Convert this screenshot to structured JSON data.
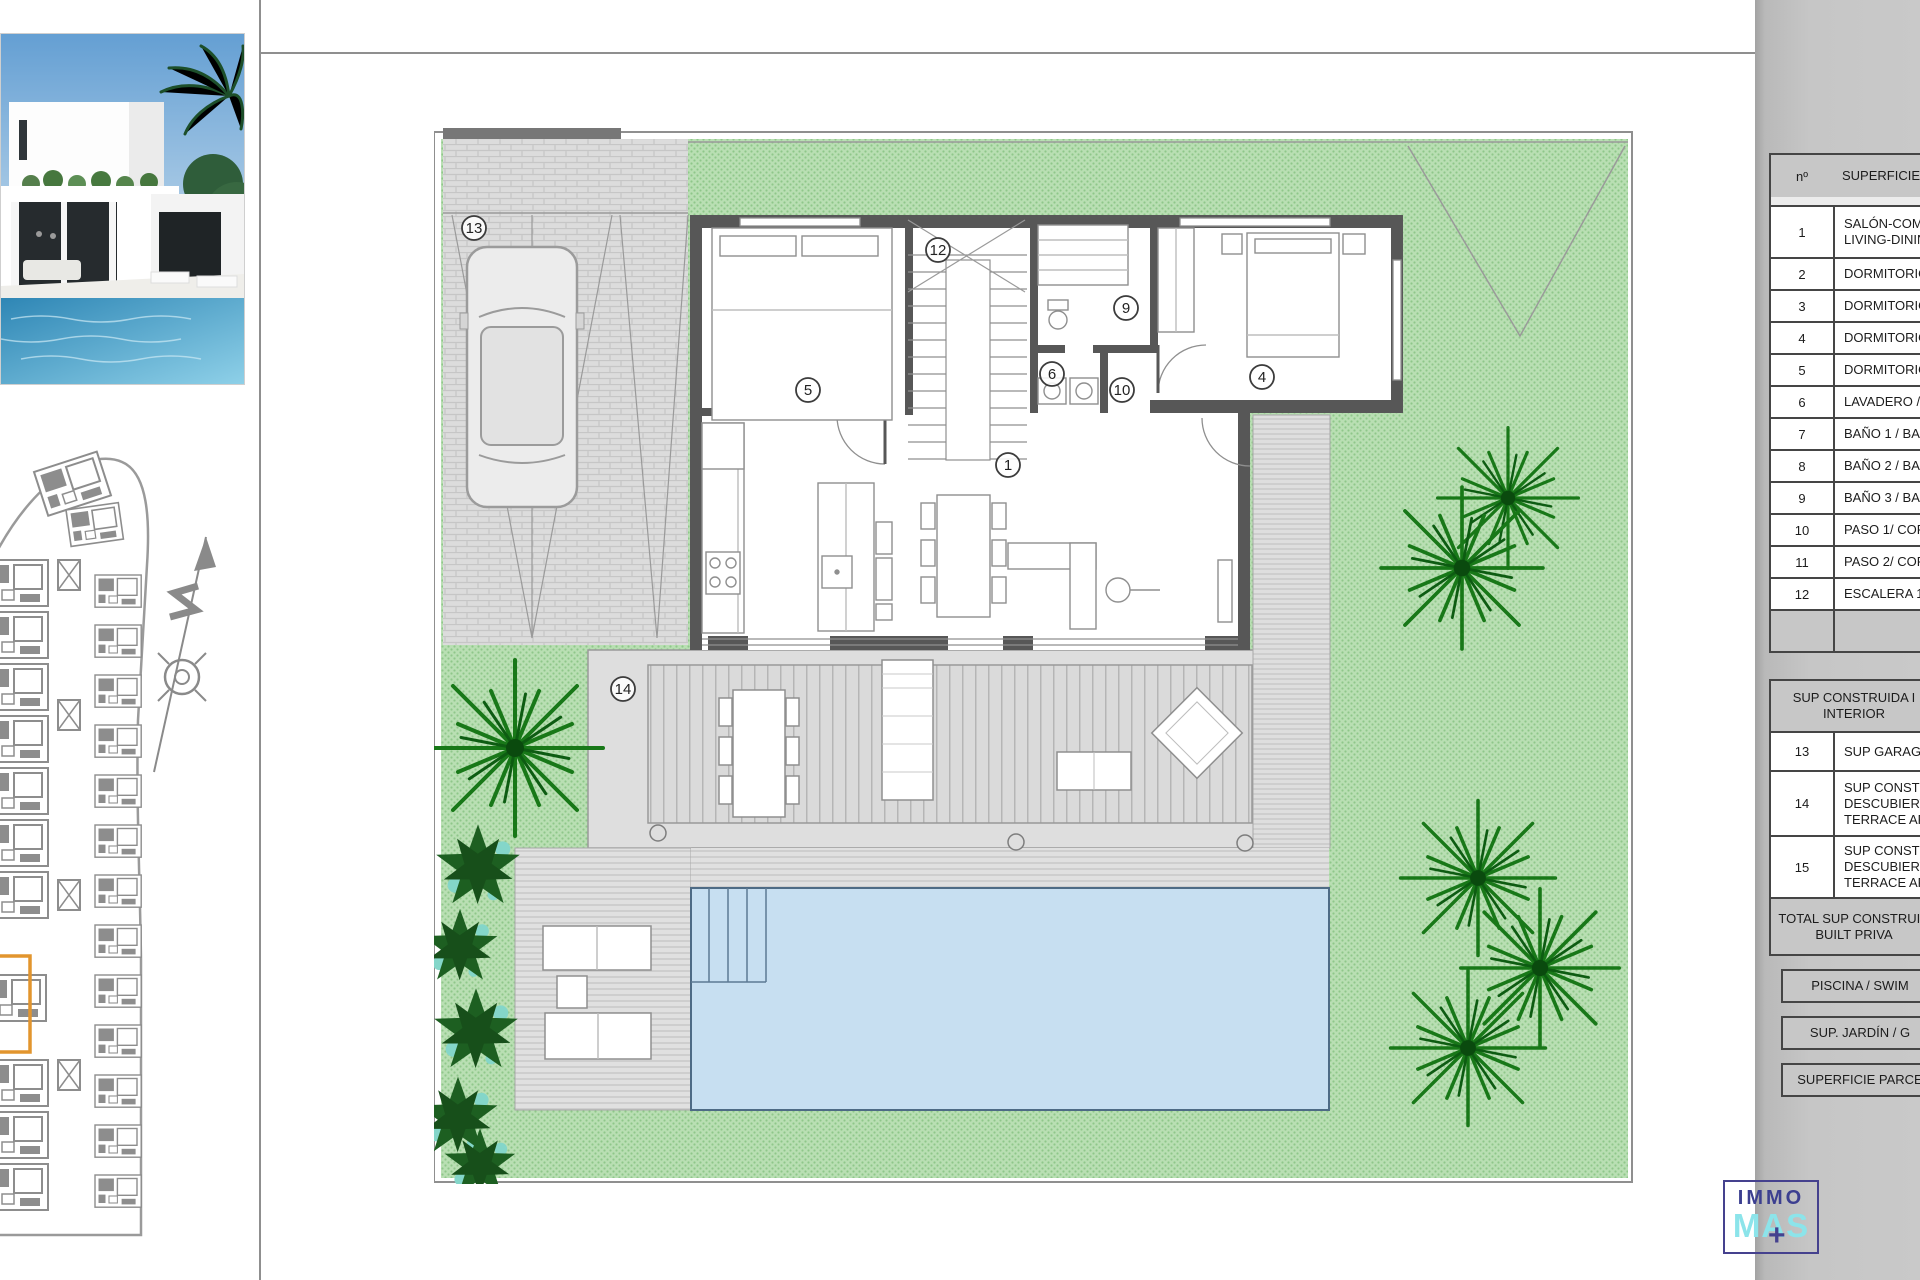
{
  "plan": {
    "room_labels": [
      "1",
      "4",
      "5",
      "6",
      "9",
      "10",
      "12",
      "13",
      "14"
    ]
  },
  "table": {
    "header": {
      "num": "nº",
      "surface": "SUPERFICIE Ú"
    },
    "rooms": [
      {
        "num": "1",
        "lines": [
          "SALÓN-COM",
          "LIVING-DININ"
        ]
      },
      {
        "num": "2",
        "lines": [
          "DORMITORIO"
        ]
      },
      {
        "num": "3",
        "lines": [
          "DORMITORIO"
        ]
      },
      {
        "num": "4",
        "lines": [
          "DORMITORIO"
        ]
      },
      {
        "num": "5",
        "lines": [
          "DORMITORIO"
        ]
      },
      {
        "num": "6",
        "lines": [
          "LAVADERO /"
        ]
      },
      {
        "num": "7",
        "lines": [
          "BAÑO 1 / BA"
        ]
      },
      {
        "num": "8",
        "lines": [
          "BAÑO 2 / BA"
        ]
      },
      {
        "num": "9",
        "lines": [
          "BAÑO 3 / BA"
        ]
      },
      {
        "num": "10",
        "lines": [
          "PASO 1/ COR"
        ]
      },
      {
        "num": "11",
        "lines": [
          "PASO 2/ COR"
        ]
      },
      {
        "num": "12",
        "lines": [
          "ESCALERA 1 /"
        ]
      }
    ],
    "interior_header": [
      "SUP CONSTRUIDA I",
      "INTERIOR"
    ],
    "extras": [
      {
        "num": "13",
        "lines": [
          "SUP GARAGE"
        ]
      },
      {
        "num": "14",
        "lines": [
          "SUP CONSTR",
          "DESCUBIERTA",
          "TERRACE ARE"
        ]
      },
      {
        "num": "15",
        "lines": [
          "SUP CONSTR",
          "DESCUBIERTA",
          "TERRACE ARE"
        ]
      }
    ],
    "total": [
      "TOTAL SUP CONSTRUID",
      "BUILT PRIVA"
    ],
    "summary": {
      "pool": "PISCINA / SWIM",
      "garden": "SUP. JARDÍN / G",
      "plot": "SUPERFICIE PARCE"
    }
  },
  "logo": {
    "top": "IMMO",
    "bottom": "MAS",
    "plus": "+"
  },
  "colors": {
    "garden_green": "#b9dfb3",
    "pool_blue": "#c7dff1",
    "wall_gray": "#575757",
    "highlight_orange": "#e2952e",
    "logo_indigo": "#3c3f90",
    "logo_cyan": "#8ce4ea"
  }
}
